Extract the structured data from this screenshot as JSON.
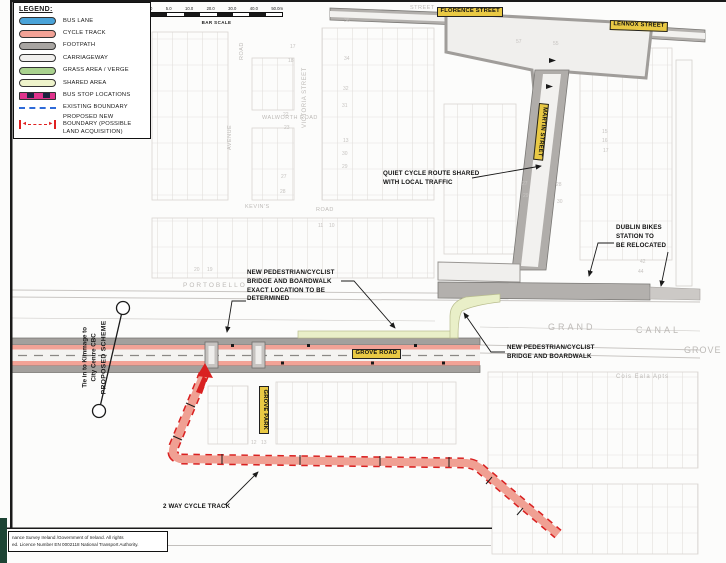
{
  "legend": {
    "title": "LEGEND:",
    "items": [
      {
        "label": "BUS LANE",
        "swatch": "pill",
        "color": "#4aa3d8"
      },
      {
        "label": "CYCLE TRACK",
        "swatch": "pill",
        "color": "#f2a296"
      },
      {
        "label": "FOOTPATH",
        "swatch": "pill",
        "color": "#a8a5a2"
      },
      {
        "label": "CARRIAGEWAY",
        "swatch": "pill",
        "color": "#f1f0ee"
      },
      {
        "label": "GRASS AREA / VERGE",
        "swatch": "pill",
        "color": "#a9d28e"
      },
      {
        "label": "SHARED AREA",
        "swatch": "pill",
        "color": "#eef3cb"
      },
      {
        "label": "BUS STOP LOCATIONS",
        "swatch": "busstop",
        "color": "#e0338c"
      },
      {
        "label": "EXISTING BOUNDARY",
        "swatch": "dash",
        "color": "#2f6bd8"
      },
      {
        "label": "PROPOSED NEW BOUNDARY (POSSIBLE LAND ACQUISITION)",
        "swatch": "bound",
        "color": "#e02020"
      }
    ]
  },
  "scale_bar": {
    "ticks": [
      "0",
      "5.0",
      "10.0",
      "20.0",
      "30.0",
      "40.0",
      "50.0m"
    ],
    "caption": "BAR SCALE"
  },
  "matchline": {
    "line1": "Tie in to Kimmage to",
    "line2": "City Centre CBC",
    "line3": "PROPOSED SCHEME"
  },
  "map": {
    "street_labels": [
      {
        "text": "FLORENCE STREET",
        "x": 437,
        "y": 7,
        "rot": 0
      },
      {
        "text": "LENNOX STREET",
        "x": 610,
        "y": 20,
        "rot": 2
      },
      {
        "text": "MARTIN STREET",
        "x": 549,
        "y": 104,
        "rot": 96
      },
      {
        "text": "GROVE ROAD",
        "x": 352,
        "y": 349,
        "rot": 0
      },
      {
        "text": "GROVE PARK",
        "x": 269,
        "y": 386,
        "rot": 90
      }
    ],
    "annotations": [
      {
        "lines": [
          "QUIET CYCLE ROUTE SHARED",
          "WITH LOCAL TRAFFIC"
        ],
        "x": 383,
        "y": 170
      },
      {
        "lines": [
          "DUBLIN BIKES",
          "STATION TO",
          "BE RELOCATED"
        ],
        "x": 616,
        "y": 224
      },
      {
        "lines": [
          "NEW PEDESTRIAN/CYCLIST",
          "BRIDGE AND BOARDWALK",
          "EXACT LOCATION TO BE",
          "DETERMINED"
        ],
        "x": 247,
        "y": 269
      },
      {
        "lines": [
          "NEW PEDESTRIAN/CYCLIST",
          "BRIDGE AND BOARDWALK"
        ],
        "x": 507,
        "y": 344
      },
      {
        "lines": [
          "2 WAY CYCLE TRACK"
        ],
        "x": 163,
        "y": 503
      }
    ],
    "faint_labels": [
      {
        "text": "STREET",
        "x": 410,
        "y": 6,
        "size": 5.5
      },
      {
        "text": "VICTORIA STREET",
        "x": 302,
        "y": 128,
        "rot": -90,
        "size": 6
      },
      {
        "text": "ROAD",
        "x": 240,
        "y": 60,
        "rot": -90,
        "size": 5.5
      },
      {
        "text": "AVENUE",
        "x": 228,
        "y": 150,
        "rot": -90,
        "size": 5.5
      },
      {
        "text": "WALWORTH ROAD",
        "x": 262,
        "y": 116,
        "size": 5.5
      },
      {
        "text": "KEVIN'S",
        "x": 245,
        "y": 205,
        "size": 5.5
      },
      {
        "text": "ROAD",
        "x": 316,
        "y": 208,
        "size": 5.5
      },
      {
        "text": "PORTOBELLO",
        "x": 183,
        "y": 283,
        "size": 6.5,
        "ls": 2
      },
      {
        "text": "GRAND",
        "x": 548,
        "y": 323,
        "size": 9,
        "ls": 3
      },
      {
        "text": "CANAL",
        "x": 636,
        "y": 326,
        "size": 9,
        "ls": 3
      },
      {
        "text": "GROVE",
        "x": 684,
        "y": 346,
        "size": 9,
        "ls": 1
      },
      {
        "text": "Cois Eala Apts",
        "x": 616,
        "y": 374,
        "size": 6,
        "ls": 1
      }
    ],
    "house_numbers": [
      [
        "17",
        290,
        45
      ],
      [
        "18",
        288,
        59
      ],
      [
        "22",
        283,
        113
      ],
      [
        "23",
        284,
        126
      ],
      [
        "27",
        281,
        175
      ],
      [
        "28",
        280,
        190
      ],
      [
        "36",
        344,
        19
      ],
      [
        "34",
        344,
        57
      ],
      [
        "32",
        343,
        87
      ],
      [
        "31",
        342,
        104
      ],
      [
        "13",
        343,
        139
      ],
      [
        "30",
        342,
        152
      ],
      [
        "29",
        342,
        165
      ],
      [
        "20",
        194,
        268
      ],
      [
        "19",
        207,
        268
      ],
      [
        "11",
        318,
        224
      ],
      [
        "10",
        329,
        224
      ],
      [
        "57",
        516,
        40
      ],
      [
        "55",
        553,
        42
      ],
      [
        "15",
        602,
        130
      ],
      [
        "16",
        602,
        139
      ],
      [
        "17",
        603,
        149
      ],
      [
        "27",
        522,
        182
      ],
      [
        "29",
        523,
        194
      ],
      [
        "28",
        556,
        183
      ],
      [
        "30",
        557,
        200
      ],
      [
        "42",
        640,
        260
      ],
      [
        "44",
        638,
        270
      ],
      [
        "12",
        251,
        441
      ],
      [
        "13",
        261,
        441
      ]
    ]
  },
  "footer": {
    "line1": "nance Survey Ireland /Government of Ireland. All rights",
    "line2": "ed. Licence Number EN 0002118 National Transport Authority."
  },
  "colors": {
    "bus_lane": "#4aa3d8",
    "cycle_track": "#f2a296",
    "footpath": "#a8a5a2",
    "carriageway": "#f1f0ee",
    "grass_verge": "#a9d28e",
    "shared_area": "#eef3cb",
    "bus_stop": "#e0338c",
    "existing_boundary": "#2f6bd8",
    "proposed_boundary": "#e02020",
    "street_label_bg": "#e9c944"
  }
}
